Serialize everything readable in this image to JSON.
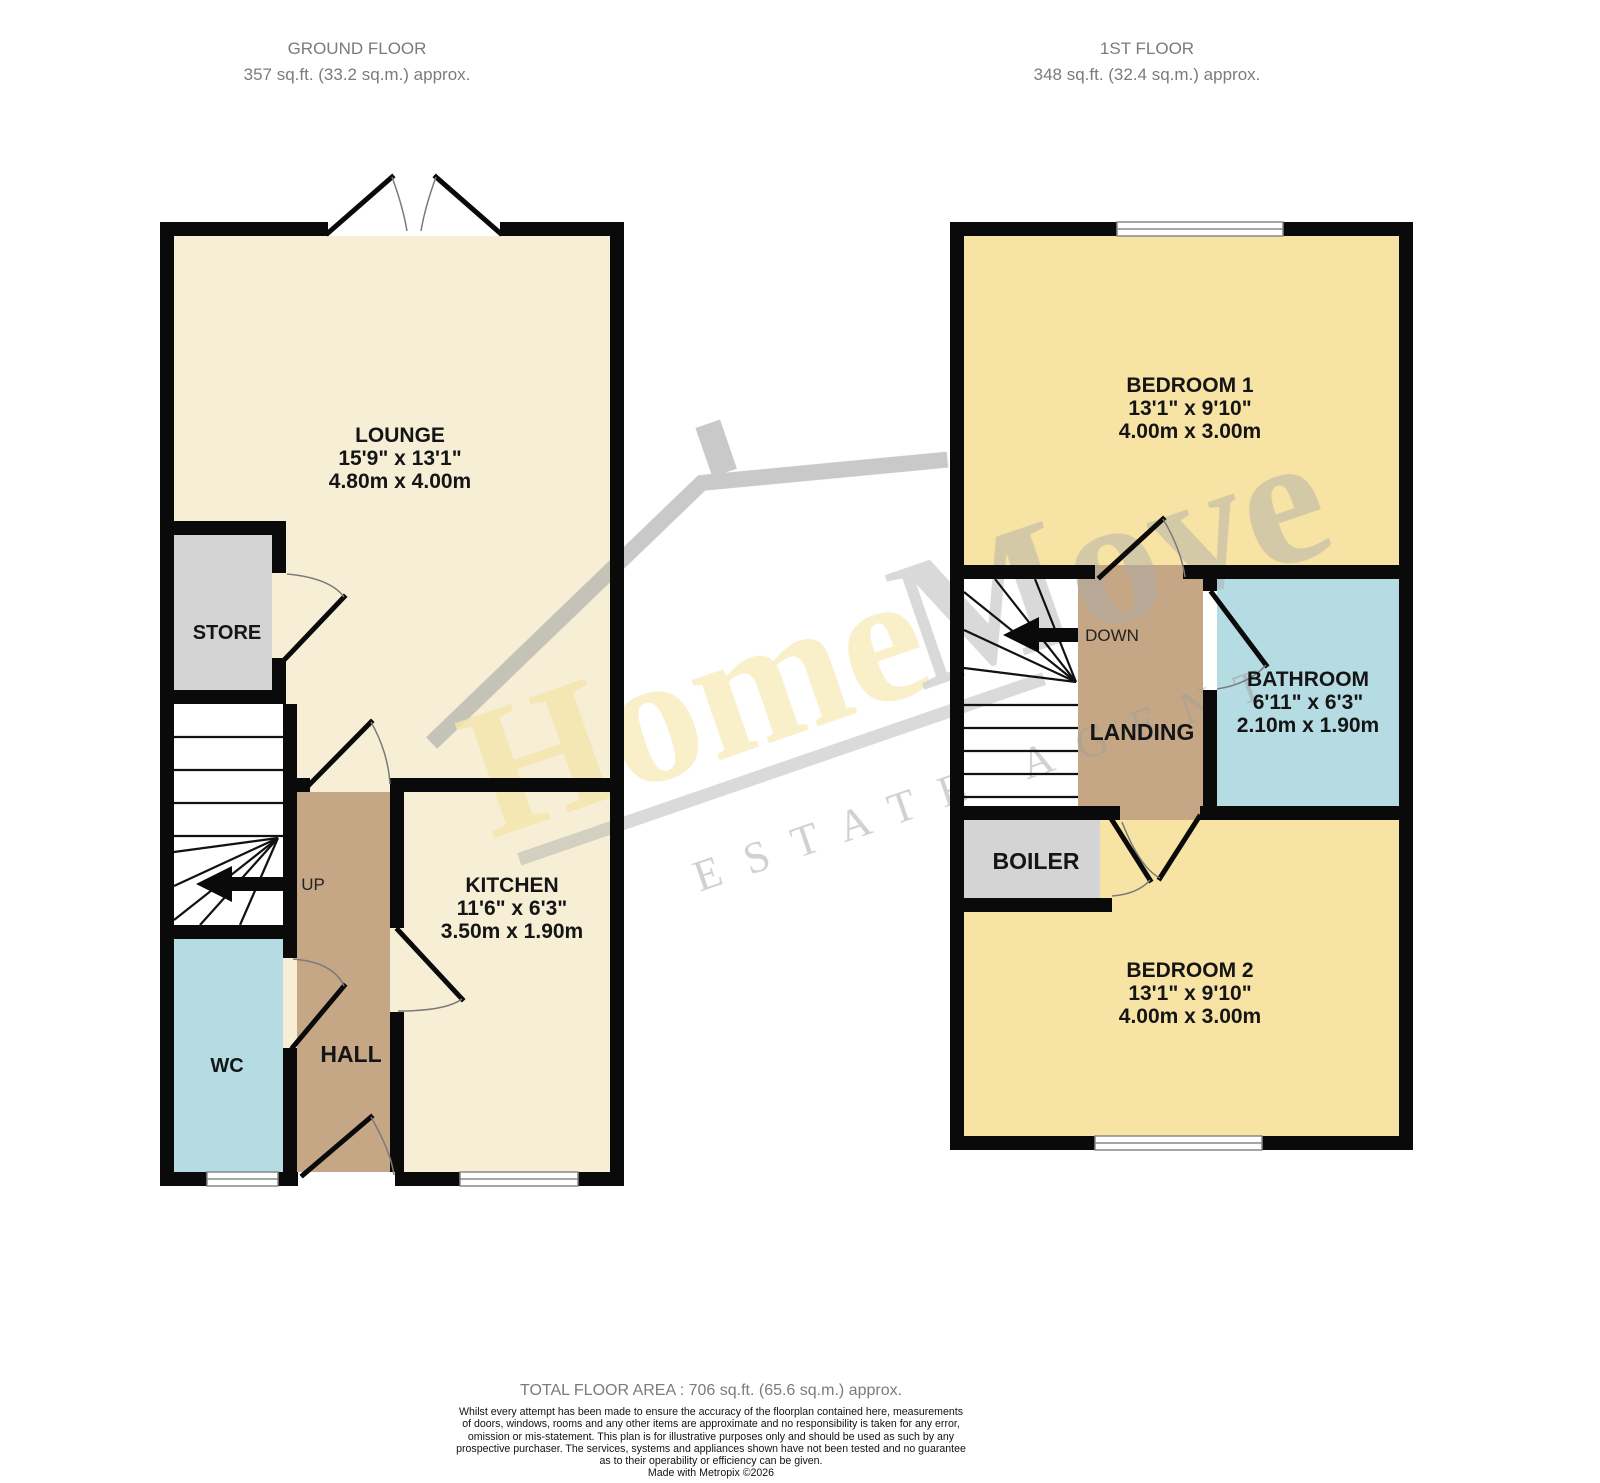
{
  "header": {
    "ground": {
      "title": "GROUND FLOOR",
      "area": "357 sq.ft. (33.2 sq.m.) approx."
    },
    "first": {
      "title": "1ST FLOOR",
      "area": "348 sq.ft. (32.4 sq.m.) approx."
    }
  },
  "rooms": {
    "lounge": {
      "name": "LOUNGE",
      "imperial": "15'9\" x 13'1\"",
      "metric": "4.80m x 4.00m"
    },
    "kitchen": {
      "name": "KITCHEN",
      "imperial": "11'6\" x 6'3\"",
      "metric": "3.50m x 1.90m"
    },
    "bedroom1": {
      "name": "BEDROOM 1",
      "imperial": "13'1\" x 9'10\"",
      "metric": "4.00m x 3.00m"
    },
    "bedroom2": {
      "name": "BEDROOM 2",
      "imperial": "13'1\" x 9'10\"",
      "metric": "4.00m x 3.00m"
    },
    "bathroom": {
      "name": "BATHROOM",
      "imperial": "6'11\" x 6'3\"",
      "metric": "2.10m x 1.90m"
    },
    "store": {
      "name": "STORE"
    },
    "wc": {
      "name": "WC"
    },
    "hall": {
      "name": "HALL"
    },
    "landing": {
      "name": "LANDING"
    },
    "boiler": {
      "name": "BOILER"
    }
  },
  "stairs": {
    "up_label": "UP",
    "down_label": "DOWN"
  },
  "watermark": {
    "brand_home": "Home",
    "brand_move": "Move",
    "tagline": "ESTATE AGENT"
  },
  "footer": {
    "total": "TOTAL FLOOR AREA : 706 sq.ft. (65.6 sq.m.) approx.",
    "disclaimer_lines": [
      "Whilst every attempt has been made to ensure the accuracy of the floorplan contained here, measurements",
      "of doors, windows, rooms and any other items are approximate and no responsibility is taken for any error,",
      "omission or mis-statement. This plan is for illustrative purposes only and should be used as such by any",
      "prospective purchaser. The services, systems and appliances shown have not been tested and no guarantee",
      "as to their operability or efficiency can be given."
    ],
    "credit": "Made with Metropix ©2026"
  },
  "colors": {
    "cream": "#F6EFD6",
    "bedroom_yellow": "#F7E3A4",
    "hall_tan": "#C5A785",
    "bath_blue": "#B5DBE3",
    "utility_gray": "#D4D4D4",
    "wall_black": "#0A0A0A",
    "watermark_yellow": "#F1DE8E",
    "watermark_gray": "#A6A6A6"
  }
}
